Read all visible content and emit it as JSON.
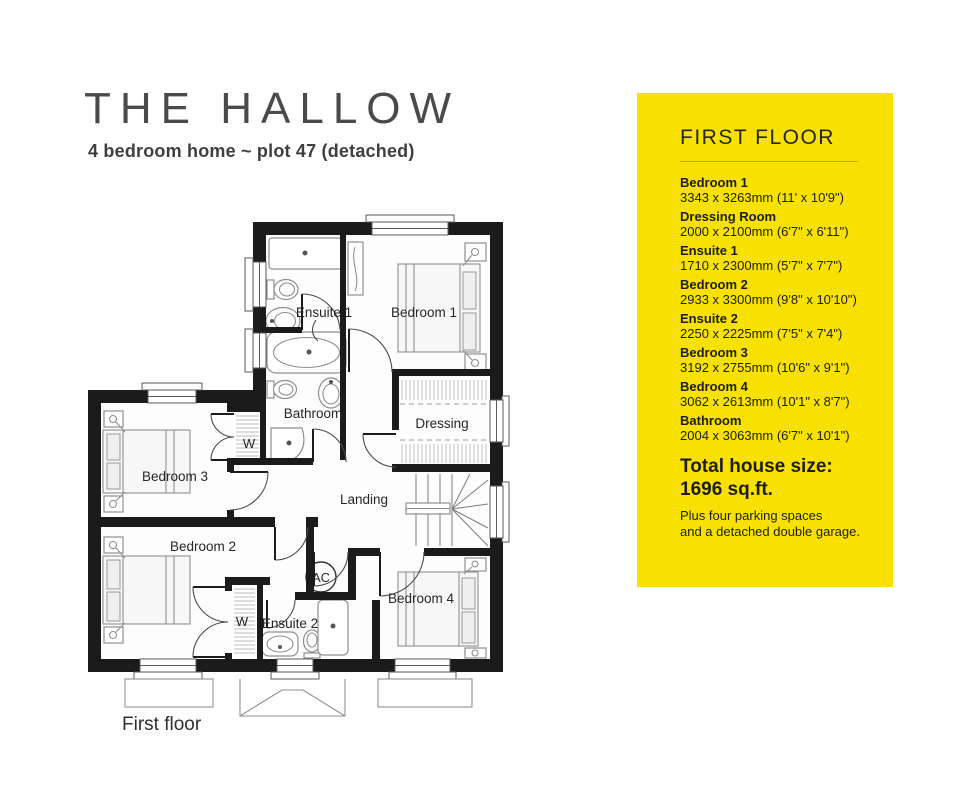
{
  "header": {
    "title": "THE HALLOW",
    "subtitle": "4 bedroom home ~ plot 47 (detached)"
  },
  "panel": {
    "heading": "FIRST FLOOR",
    "bg_color": "#F8E100",
    "rooms": [
      {
        "name": "Bedroom 1",
        "dims": "3343 x 3263mm (11' x 10'9\")"
      },
      {
        "name": "Dressing Room",
        "dims": "2000 x 2100mm (6'7\" x 6'11\")"
      },
      {
        "name": "Ensuite 1",
        "dims": "1710 x 2300mm (5'7\" x 7'7\")"
      },
      {
        "name": "Bedroom 2",
        "dims": "2933 x 3300mm (9'8\" x 10'10\")"
      },
      {
        "name": "Ensuite 2",
        "dims": "2250 x 2225mm (7'5\" x 7'4\")"
      },
      {
        "name": "Bedroom 3",
        "dims": "3192 x 2755mm (10'6\" x 9'1\")"
      },
      {
        "name": "Bedroom 4",
        "dims": "3062 x 2613mm (10'1\" x 8'7\")"
      },
      {
        "name": "Bathroom",
        "dims": "2004 x 3063mm (6'7\" x 10'1\")"
      }
    ],
    "total_label": "Total house size:",
    "total_value": "1696 sq.ft.",
    "note_line1": "Plus four parking spaces",
    "note_line2": "and a detached double garage."
  },
  "plan": {
    "caption": "First floor",
    "labels": {
      "ensuite1": "Ensuite 1",
      "bedroom1": "Bedroom 1",
      "bathroom": "Bathroom",
      "dressing": "Dressing",
      "bedroom3": "Bedroom 3",
      "landing": "Landing",
      "bedroom2": "Bedroom 2",
      "ensuite2": "Ensuite 2",
      "bedroom4": "Bedroom 4",
      "wardrobe": "W",
      "ac": "AC"
    }
  }
}
